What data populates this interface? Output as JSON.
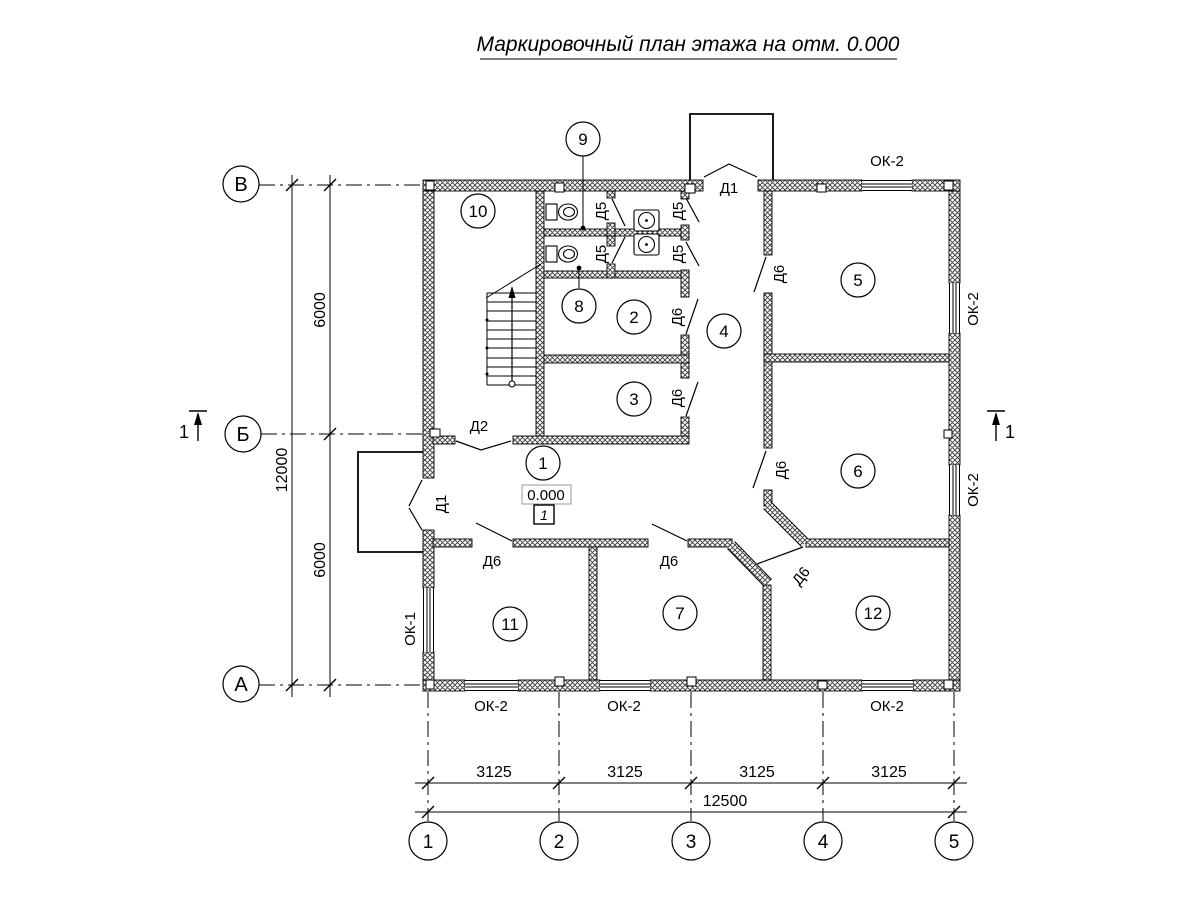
{
  "plan": {
    "title": "Маркировочный план этажа на отм. 0.000"
  },
  "axes": {
    "row_labels": [
      "В",
      "Б",
      "А"
    ],
    "col_labels": [
      "1",
      "2",
      "3",
      "4",
      "5"
    ]
  },
  "dims": {
    "spacing": "3125",
    "total_width": "12500",
    "half_height": "6000",
    "total_height": "12000"
  },
  "rooms": {
    "r1": "1",
    "r2": "2",
    "r3": "3",
    "r4": "4",
    "r5": "5",
    "r6": "6",
    "r7": "7",
    "r8": "8",
    "r9": "9",
    "r10": "10",
    "r11": "11",
    "r12": "12"
  },
  "doors": {
    "d1": "Д1",
    "d2": "Д2",
    "d5": "Д5",
    "d6": "Д6"
  },
  "windows": {
    "ok1": "ОК-1",
    "ok2": "ОК-2"
  },
  "marks": {
    "elevation": "0.000",
    "floor_type": "1",
    "section": "1"
  }
}
